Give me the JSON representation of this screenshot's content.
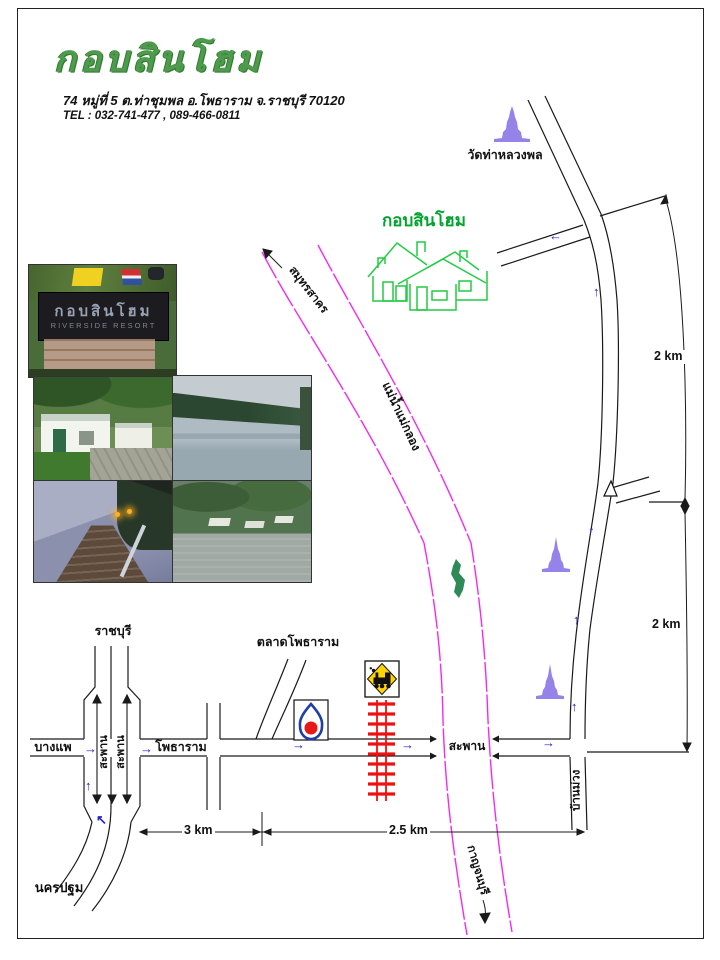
{
  "header": {
    "title": "กอบสินโฮม",
    "address": "74 หมู่ที่ 5 ต.ท่าชุมพล อ.โพธาราม จ.ราชบุรี 70120",
    "tel": "TEL : 032-741-477 , 089-466-0811"
  },
  "map": {
    "labels": {
      "wat": "วัดท่าหลวงพล",
      "resort": "กอบสินโฮม",
      "river": "แม่น้ำแม่กลอง",
      "downstream": "สมุทรสาคร",
      "upstream": "กาญจนบุรี",
      "market": "ตลาดโพธาราม",
      "bridge": "สะพาน",
      "overpass": "สะพาน",
      "ratchaburi": "ราชบุรี",
      "bangphae": "บางแพ",
      "nakhon_pathom": "นครปฐม",
      "photharam": "โพธาราม",
      "ban_muang": "บ้านม่วง"
    },
    "distances": {
      "upper": "2 km",
      "lower": "2 km",
      "west": "3 km",
      "east": "2.5 km"
    },
    "arrows": {
      "up": "↑",
      "right": "→",
      "left": "←",
      "up_left": "↖"
    },
    "colors": {
      "road": "#1a1a1a",
      "river": "#F02BF0",
      "railway": "#EE1111",
      "direction_arrow": "#2222CC",
      "temple": "#9683EA",
      "houses": "#22CC44",
      "title_green": "#4E9B4E",
      "rail_sign_yellow": "#FFD400",
      "ptt_blue": "#1F3FA8",
      "ptt_red": "#E81818"
    },
    "icons": [
      "temple-icon",
      "temple-icon",
      "temple-icon",
      "ptt-gas-station-icon",
      "railroad-crossing-sign-icon",
      "resort-houses-drawing",
      "river-island",
      "fork-marker"
    ]
  },
  "photos": {
    "sign_line1": "กอบสินโฮม",
    "sign_line2": "RIVERSIDE RESORT"
  }
}
